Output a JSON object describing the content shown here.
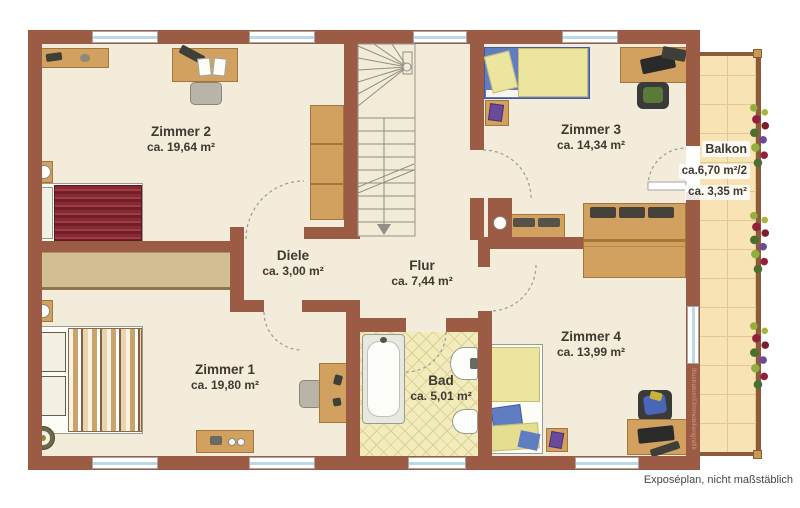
{
  "rooms": {
    "zimmer2": {
      "name": "Zimmer 2",
      "area": "ca. 19,64 m²"
    },
    "zimmer1": {
      "name": "Zimmer 1",
      "area": "ca. 19,80 m²"
    },
    "zimmer3": {
      "name": "Zimmer 3",
      "area": "ca. 14,34 m²"
    },
    "zimmer4": {
      "name": "Zimmer 4",
      "area": "ca. 13,99 m²"
    },
    "diele": {
      "name": "Diele",
      "area": "ca. 3,00 m²"
    },
    "flur": {
      "name": "Flur",
      "area": "ca. 7,44 m²"
    },
    "bad": {
      "name": "Bad",
      "area": "ca. 5,01 m²"
    },
    "balkon": {
      "name": "Balkon",
      "area_line1": "ca.6,70 m²/2",
      "area_line2": "ca. 3,35 m²"
    }
  },
  "footer_note": "Exposéplan, nicht maßstäblich",
  "watermark": "Illustration©Immobiliengrafik",
  "colors": {
    "wall": "#9c5b45",
    "floor": "#f3ecda",
    "bath_tile": "#f2ecbd",
    "balcony_tile": "#f7e3b4",
    "wood": "#d2a05f",
    "bed_red": "#7d2730",
    "bed_blue": "#5f7ec2",
    "blanket_yellow": "#ece5a0",
    "background": "#ffffff"
  }
}
